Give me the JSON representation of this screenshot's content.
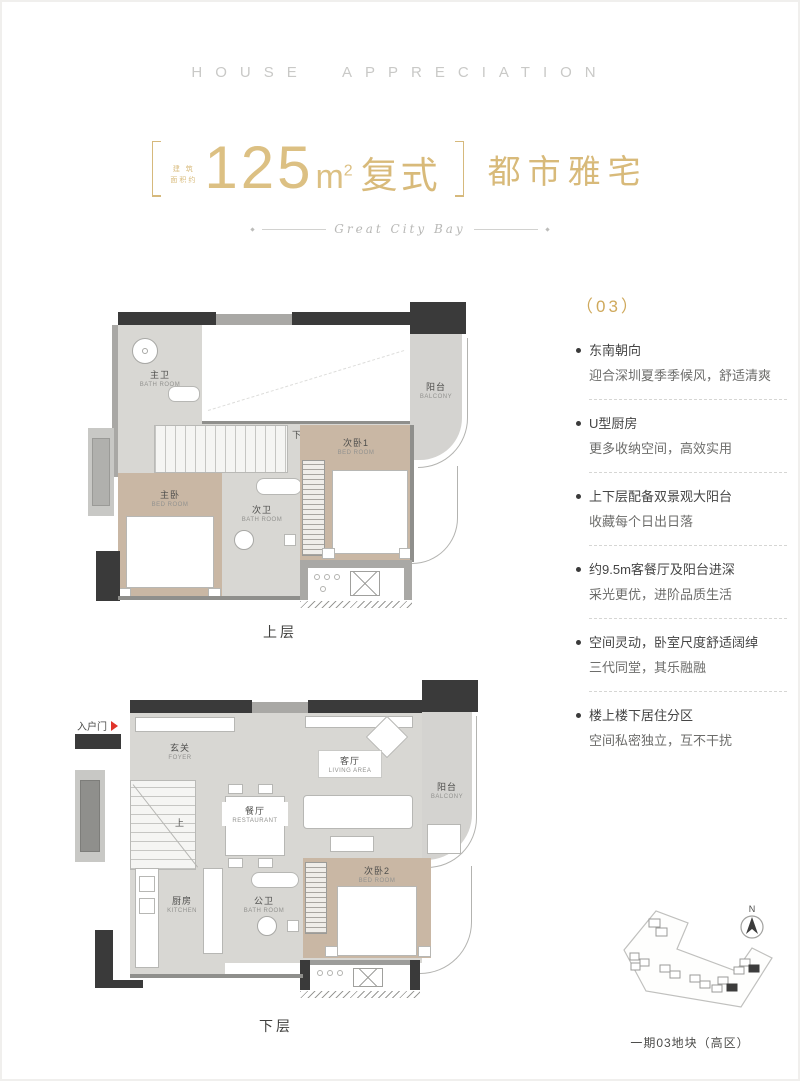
{
  "header": {
    "title": "HOUSE APPRECIATION"
  },
  "title": {
    "bracket_note_line1": "建 筑",
    "bracket_note_line2": "面积约",
    "area_number": "125",
    "area_unit": "m",
    "area_sup": "2",
    "area_suffix": "复式",
    "subtitle": "都市雅宅",
    "script": "Great City Bay"
  },
  "features": {
    "index_label": "（03）",
    "items": [
      {
        "title": "东南朝向",
        "desc": "迎合深圳夏季季候风，舒适清爽"
      },
      {
        "title": "U型厨房",
        "desc": "更多收纳空间，高效实用"
      },
      {
        "title": "上下层配备双景观大阳台",
        "desc": "收藏每个日出日落"
      },
      {
        "title": "约9.5m客餐厅及阳台进深",
        "desc": "采光更优，进阶品质生活"
      },
      {
        "title": "空间灵动，卧室尺度舒适阔绰",
        "desc": "三代同堂，其乐融融"
      },
      {
        "title": "楼上楼下居住分区",
        "desc": "空间私密独立，互不干扰"
      }
    ]
  },
  "plans": {
    "upper": {
      "caption": "上层",
      "stair_text": "下",
      "rooms": {
        "master_bath": {
          "zh": "主卫",
          "en": "BATH ROOM"
        },
        "balcony": {
          "zh": "阳台",
          "en": "BALCONY"
        },
        "bedroom1": {
          "zh": "次卧1",
          "en": "BED ROOM"
        },
        "master_bed": {
          "zh": "主卧",
          "en": "BED ROOM"
        },
        "second_bath": {
          "zh": "次卫",
          "en": "BATH ROOM"
        }
      }
    },
    "lower": {
      "caption": "下层",
      "entry_label": "入户门",
      "stair_text": "上",
      "rooms": {
        "foyer": {
          "zh": "玄关",
          "en": "FOYER"
        },
        "living": {
          "zh": "客厅",
          "en": "LIVING AREA"
        },
        "dining": {
          "zh": "餐厅",
          "en": "RESTAURANT"
        },
        "balcony": {
          "zh": "阳台",
          "en": "BALCONY"
        },
        "kitchen": {
          "zh": "厨房",
          "en": "KITCHEN"
        },
        "public_bath": {
          "zh": "公卫",
          "en": "BATH ROOM"
        },
        "bedroom2": {
          "zh": "次卧2",
          "en": "BED ROOM"
        }
      }
    }
  },
  "siteplan": {
    "north_label": "N",
    "caption": "一期03地块（高区）"
  },
  "colors": {
    "gold": "#d6b97c",
    "wall_dark": "#3a3a3a",
    "entry_red": "#e0342b"
  }
}
